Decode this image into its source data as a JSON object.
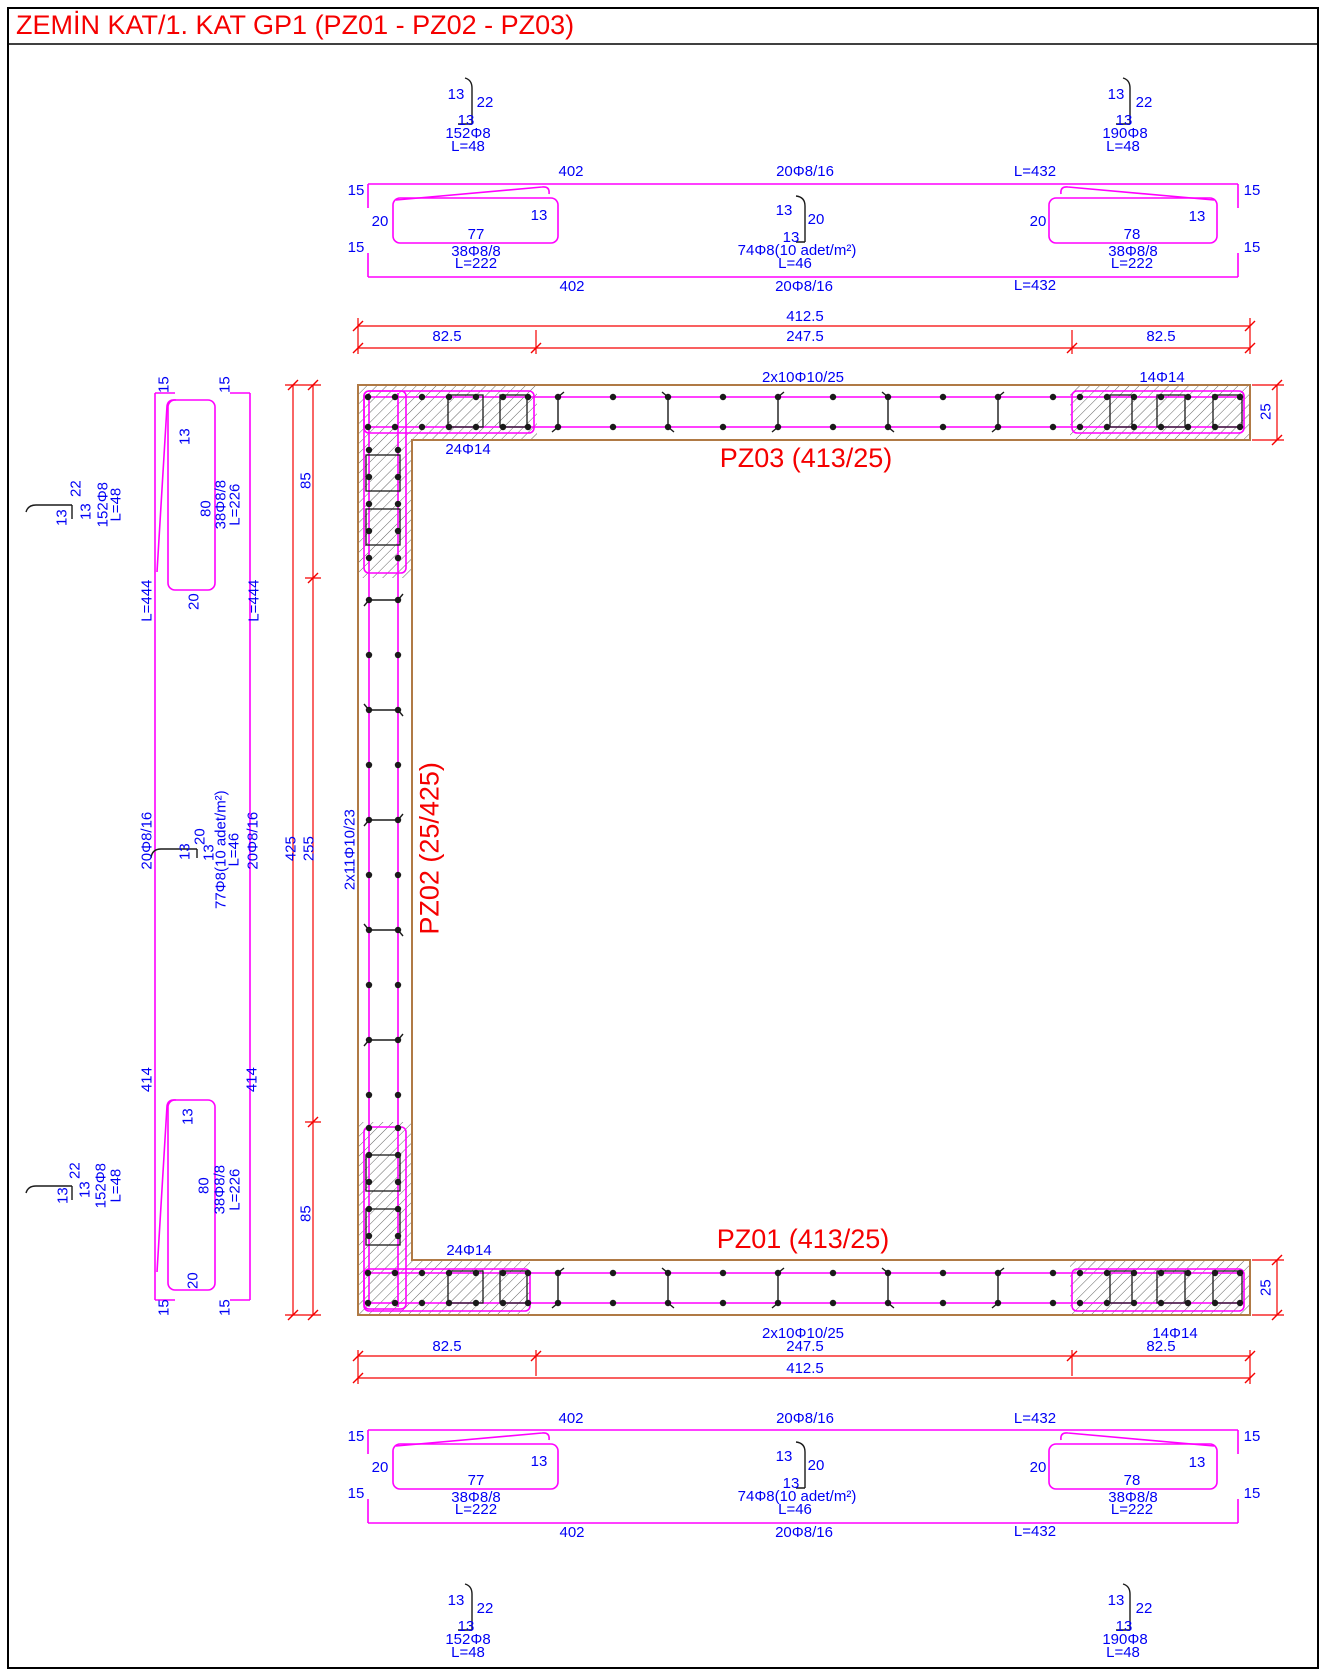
{
  "title": "ZEMİN KAT/1. KAT GP1 (PZ01 - PZ02 - PZ03)",
  "colors": {
    "rebar_line": "#ff00ff",
    "dim_line": "#ff0000",
    "label_text": "#0000ff",
    "wall_outline": "#b07a45",
    "wall_name_text": "#ff0000"
  },
  "walls": {
    "pz03": {
      "name": "PZ03 (413/25)",
      "web": "2x10Φ10/25",
      "end": "14Φ14",
      "corner": "24Φ14",
      "thk": "25"
    },
    "pz02": {
      "name": "PZ02 (25/425)",
      "web": "2x11Φ10/23"
    },
    "pz01": {
      "name": "PZ01 (413/25)",
      "web": "2x10Φ10/25",
      "end": "14Φ14",
      "corner": "24Φ14",
      "thk": "25"
    }
  },
  "dims": {
    "total": "412.5",
    "end": "82.5",
    "mid": "247.5",
    "v_total": "425",
    "v_mid": "255",
    "v_end": "85"
  },
  "details": {
    "bend": "13",
    "tail": "22",
    "hook_len": "15",
    "leg": "20",
    "tie152": {
      "mark": "152Φ8",
      "len": "L=48"
    },
    "tie190": {
      "mark": "190Φ8",
      "len": "L=48"
    },
    "stirrup77": {
      "width": "77",
      "mark": "38Φ8/8",
      "len": "L=222"
    },
    "stirrup78": {
      "width": "78",
      "mark": "38Φ8/8",
      "len": "L=222"
    },
    "stirrup80": {
      "width": "80",
      "mark": "38Φ8/8",
      "len": "L=226"
    },
    "web74": {
      "mark": "74Φ8(10 adet/m²)",
      "len": "L=46"
    },
    "web77": {
      "mark": "77Φ8(10 adet/m²)",
      "len": "L=46"
    },
    "bar402": "402",
    "bar2016": "20Φ8/16",
    "bar432": "L=432",
    "bar444": "L=444",
    "bar414": "414"
  }
}
